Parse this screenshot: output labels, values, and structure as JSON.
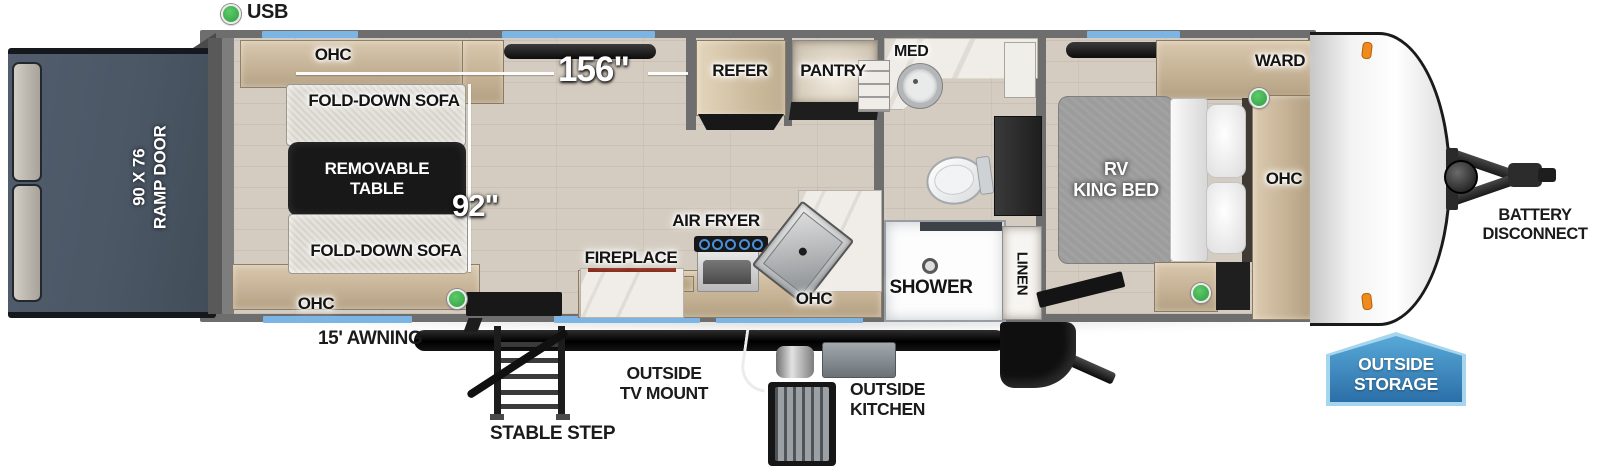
{
  "legend": {
    "usb": "USB"
  },
  "measurements": {
    "length": "156\"",
    "width": "92\""
  },
  "ramp": {
    "line1": "90 X 76",
    "line2": "RAMP DOOR"
  },
  "garage": {
    "ohc_top": "OHC",
    "sofa_top": "FOLD-DOWN SOFA",
    "table_line1": "REMOVABLE",
    "table_line2": "TABLE",
    "sofa_bottom": "FOLD-DOWN SOFA",
    "ohc_bottom": "OHC"
  },
  "kitchen": {
    "refer": "REFER",
    "pantry": "PANTRY",
    "fireplace": "FIREPLACE",
    "air_fryer": "AIR FRYER",
    "ohc": "OHC"
  },
  "bathroom": {
    "med": "MED",
    "shower": "SHOWER",
    "linen": "LINEN"
  },
  "bedroom": {
    "ward": "WARD",
    "bed_line1": "RV",
    "bed_line2": "KING BED",
    "ohc": "OHC"
  },
  "exterior": {
    "awning": "15' AWNING",
    "stable_step": "STABLE STEP",
    "tv_mount_line1": "OUTSIDE",
    "tv_mount_line2": "TV MOUNT",
    "outside_kitchen_line1": "OUTSIDE",
    "outside_kitchen_line2": "KITCHEN",
    "battery_line1": "BATTERY",
    "battery_line2": "DISCONNECT",
    "storage_line1": "OUTSIDE",
    "storage_line2": "STORAGE"
  },
  "colors": {
    "window_blue": "#7cb5e3",
    "usb_green": "#3db54d",
    "badge_blue": "#2f78b0",
    "badge_border": "#a5d6ee"
  }
}
